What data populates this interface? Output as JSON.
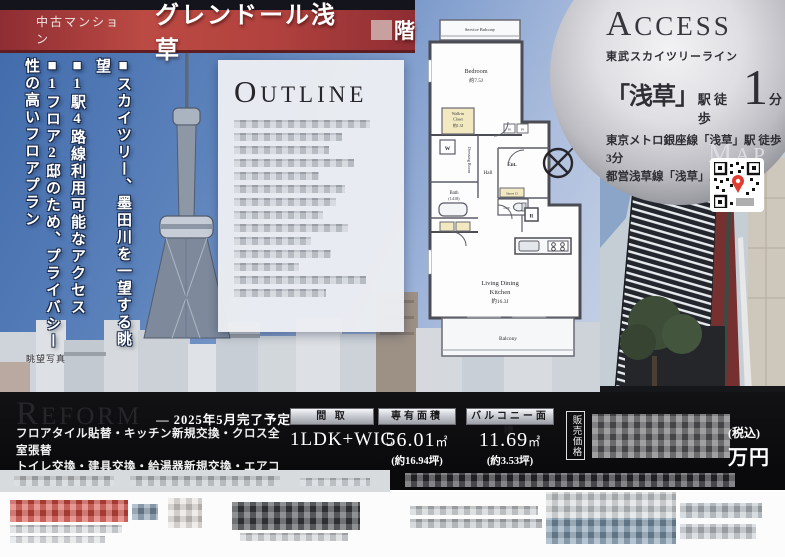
{
  "banner": {
    "property_type": "中古マンション",
    "title": "グレンドール浅草",
    "floor_suffix": "階"
  },
  "photo": {
    "selling_points": [
      "■スカイツリー、墨田川を一望する眺望",
      "■1駅4路線利用可能なアクセス",
      "■1フロア2邸のため、プライバシー性の高いフロアプラン"
    ],
    "caption": "眺望写真"
  },
  "outline": {
    "title": "Outline"
  },
  "floorplan": {
    "service_balcony": "Service Balcony",
    "bedroom": "Bedroom",
    "bedroom_size": "約7.5J",
    "wic_line1": "Walk-in",
    "wic_line2": "Closet",
    "wic_size": "約1.3J",
    "washer": "W",
    "dressing": "Dressing Room",
    "hall": "Hall",
    "entrance": "Ent.",
    "shoes": "Shoes Cl",
    "bath": "Bath",
    "bath_size": "(1418)",
    "lavatory": "Lav.",
    "refrigerator": "R",
    "ps1": "PS",
    "ps2": "PS",
    "ldk_line1": "Living Dining",
    "ldk_line2": "Kitchen",
    "ldk_size": "約16.3J",
    "balcony": "Balcony",
    "compass": "N"
  },
  "access": {
    "title": "Access",
    "railway": "東武スカイツリーライン",
    "station": "「浅草」",
    "station_suffix": "駅 徒歩",
    "minutes": "1",
    "minutes_unit": "分",
    "line2": "東京メトロ銀座線「浅草」駅 徒歩3分",
    "line3": "都営浅草線「浅草」駅 徒歩5分",
    "map_title": "Map"
  },
  "reform": {
    "title": "Reform",
    "schedule": "― 2025年5月完了予定 ―",
    "details": [
      "フロアタイル貼替・キッチン新規交換・クロス全室張替",
      "トイレ交換・建具交換・給湯器新規交換・エアコン2基設",
      "クリーニング　等"
    ]
  },
  "specs": {
    "layout_label": "間 取",
    "layout_value": "1LDK+WIC",
    "area_label": "専有面積",
    "area_value": "56.01",
    "area_unit": "㎡",
    "area_tsubo": "(約16.94坪)",
    "balcony_label": "バルコニー面積",
    "balcony_value": "11.69",
    "balcony_unit": "㎡",
    "balcony_tsubo": "(約3.53坪)"
  },
  "price": {
    "label": "販売価格",
    "tax_note": "(税込)",
    "unit": "万円"
  },
  "colors": {
    "banner_red": "#a83a3a",
    "panel_black": "#0b0b0e",
    "silver": "#d9d9de",
    "plan_bg": "#a9bddb",
    "accent_yellow": "#f2e9c0"
  }
}
